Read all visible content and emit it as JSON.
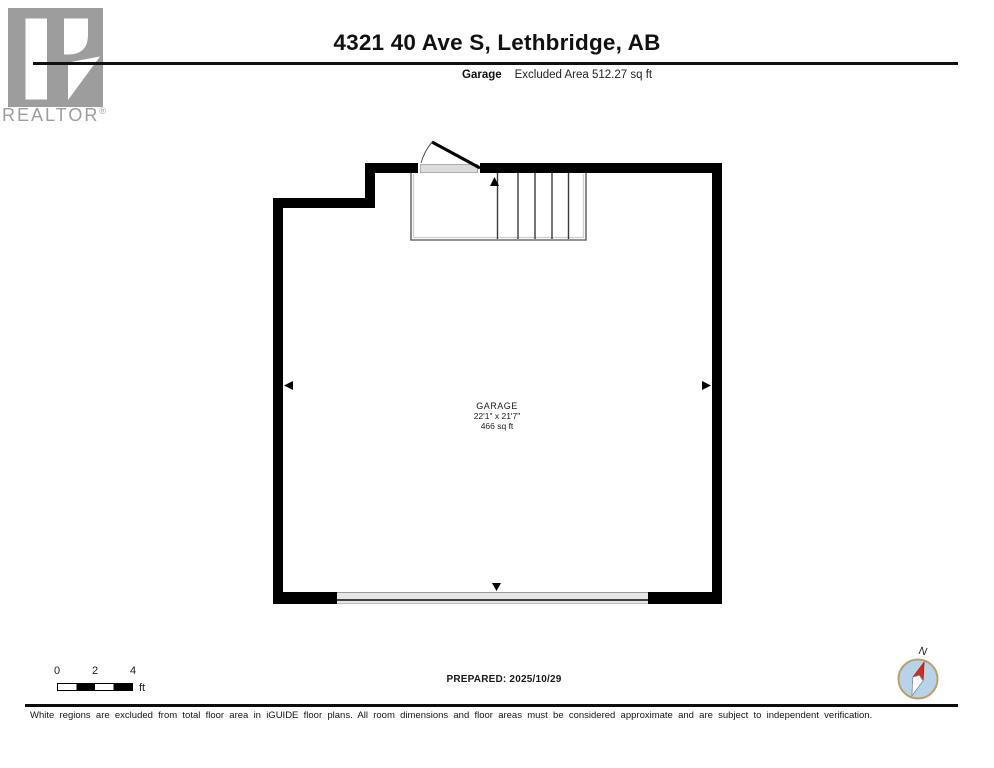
{
  "logo": {
    "brand": "REALTOR",
    "registered": "®",
    "color": "#9d9d9d"
  },
  "header": {
    "title": "4321 40 Ave S, Lethbridge, AB",
    "floor_label": "Garage",
    "excluded_area": "Excluded Area 512.27 sq ft"
  },
  "floorplan": {
    "room": {
      "name": "GARAGE",
      "dimensions": "22'1\" x 21'7\"",
      "area": "466 sq ft"
    },
    "features": [
      "entry-door-with-swing-arc",
      "staircase-five-treads",
      "garage-door-opening",
      "wall-direction-arrows"
    ],
    "colors": {
      "wall": "#000000",
      "stair_line": "#3c3c3c",
      "landing_outline": "#6e6e6e",
      "door_sill": "#dcdcdc",
      "garage_door_band": "#e6e6e6"
    }
  },
  "scale_bar": {
    "ticks": [
      "0",
      "2",
      "4"
    ],
    "unit": "ft"
  },
  "footer": {
    "prepared": "PREPARED: 2025/10/29",
    "disclaimer": "White regions are excluded from total floor area in iGUIDE floor plans. All room dimensions and floor areas must be considered approximate and are subject to independent verification.",
    "compass": {
      "label": "N",
      "ring_color": "#bf9d66",
      "face_color": "#b7d3ea",
      "needle_color": "#d42b21"
    }
  }
}
